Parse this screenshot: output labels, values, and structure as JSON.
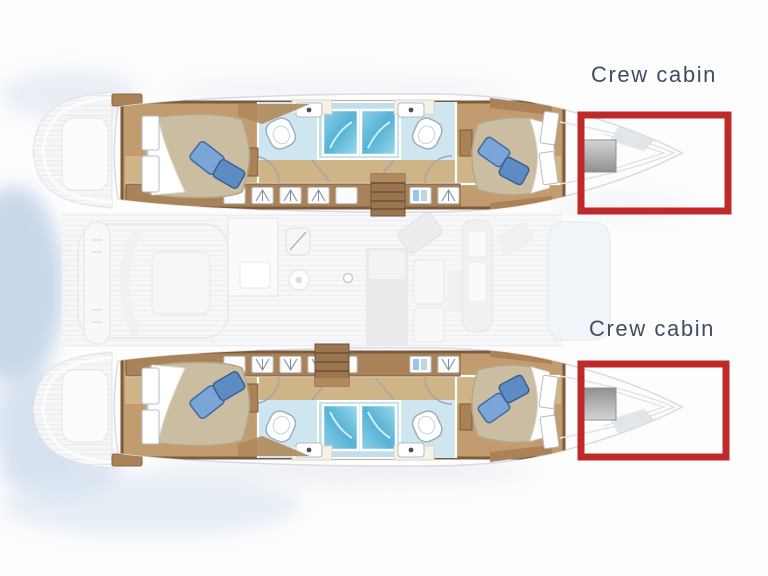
{
  "diagram": {
    "type": "catamaran-yacht-floor-plan",
    "annotations": [
      {
        "label": "Crew cabin",
        "position": "top-right",
        "target": "top-hull-bow"
      },
      {
        "label": "Crew cabin",
        "position": "bottom-right",
        "target": "bottom-hull-bow"
      }
    ],
    "highlight_color": "#be2a2a",
    "label_color": "#3f4e64",
    "features": [
      "double-bed",
      "pillows",
      "shower-stall",
      "toilet",
      "washbasin",
      "wardrobe-lockers",
      "companionway-stairs",
      "galley",
      "saloon-seating",
      "cockpit",
      "mast-step",
      "bow-hatch",
      "swim-platform",
      "foredeck"
    ]
  },
  "colors": {
    "highlight_red": "#be2a2a",
    "label_blue": "#3f4e64",
    "wood_dark": "#7d5c3c",
    "wood_mid": "#ab8257",
    "wood_floor": "#c29c6e",
    "corridor_floor": "#cfb487",
    "mattress_tan": "#cabda1",
    "pillow_blue_light": "#7aa5d7",
    "pillow_blue_dark": "#5d8cc4",
    "shower_blue": "#55b2d6",
    "bathroom_floor_blue": "#cfe5ef",
    "hatch_gray": "#b0b2b4"
  }
}
